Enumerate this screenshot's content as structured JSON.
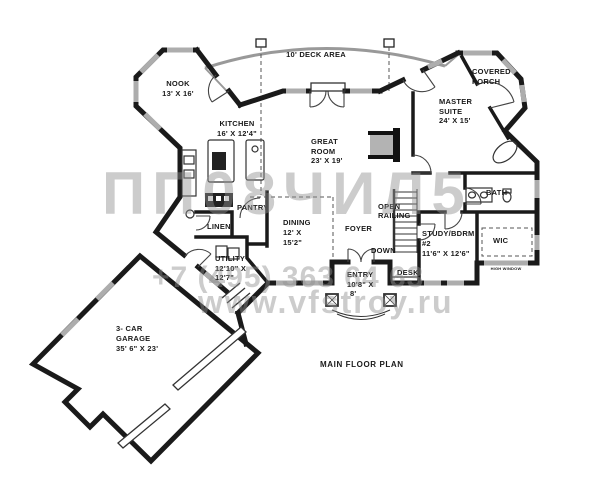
{
  "title": "MAIN FLOOR PLAN",
  "watermark": {
    "logo_text": "ПП08ЧИЛ5",
    "phone": "+7 (495) 363 64 63",
    "site": "www.vfstroy.ru"
  },
  "colors": {
    "wall": "#1a1a1a",
    "window_glazing": "#adadad",
    "deck_line": "#999999",
    "watermark_gray": "#8f8f8f",
    "label_ink": "#1a1a1a"
  },
  "rooms": {
    "deck": {
      "line1": "10' DECK AREA"
    },
    "nook": {
      "line1": "NOOK",
      "line2": "13' X 16'"
    },
    "covered_porch": {
      "line1": "COVERED",
      "line2": "PORCH"
    },
    "master_suite": {
      "line1": "MASTER",
      "line2": "SUITE",
      "line3": "24' X 15'"
    },
    "kitchen": {
      "line1": "KITCHEN",
      "line2": "16' X 12'4\""
    },
    "great_room": {
      "line1": "GREAT",
      "line2": "ROOM",
      "line3": "23' X 19'"
    },
    "pantry": {
      "line1": "PANTRY"
    },
    "linen": {
      "line1": "LINEN"
    },
    "dining": {
      "line1": "DINING",
      "line2": "12' X",
      "line3": "15'2\""
    },
    "foyer": {
      "line1": "FOYER"
    },
    "open_railing": {
      "line1": "OPEN",
      "line2": "RAILING"
    },
    "down": {
      "line1": "DOWN"
    },
    "study": {
      "line1": "STUDY/BDRM",
      "line2": "#2",
      "line3": "11'6\" X 12'6\""
    },
    "desk": {
      "line1": "DESK"
    },
    "bath": {
      "line1": "BATH"
    },
    "wic": {
      "line1": "WIC"
    },
    "high_window": {
      "line1": "HIGH WINDOW"
    },
    "entry": {
      "line1": "ENTRY",
      "line2": "10'8\" X",
      "line3": "8'"
    },
    "utility": {
      "line1": "UTILITY",
      "line2": "12'10\" X",
      "line3": "12'7\""
    },
    "garage": {
      "line1": "3- CAR",
      "line2": "GARAGE",
      "line3": "35' 6\" X 23'"
    }
  }
}
